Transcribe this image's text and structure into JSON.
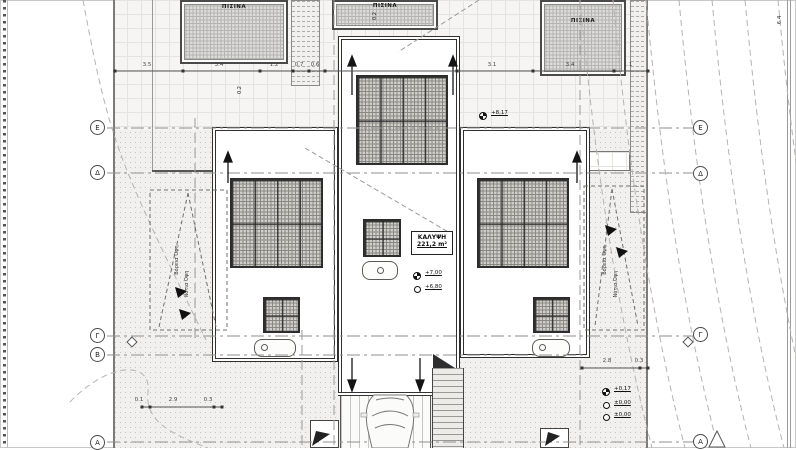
{
  "labels": {
    "pool": "ΠΙΣΙΝΑ",
    "coverage_title": "ΚΑΛΥΨΗ",
    "coverage_value": "221,2 m²",
    "slope": "Κλίση 2%",
    "view_north": "Βόρεια Όψη",
    "view_south": "Νότια Όψη"
  },
  "axes": {
    "e": "Ε",
    "d": "Δ",
    "g": "Γ",
    "b": "Β",
    "a": "Α"
  },
  "elevations": {
    "pool_deck": "+8,17",
    "roof_high": "+7,00",
    "roof_low": "+6,80",
    "entrance": "+0,17",
    "ground_a": "±0,00",
    "ground_b": "±0,00"
  },
  "dimensions": {
    "top": [
      "3.5",
      "3.4",
      "1.2",
      "0.7",
      "0.6",
      "3.1",
      "3.4",
      "1.1"
    ],
    "right_edge": "6.4",
    "pool_left_gap": "0.2",
    "pool_center_gap": "0.2",
    "bottom_left": [
      "0.1",
      "2.9",
      "0.3"
    ],
    "right_lower": [
      "2.8",
      "0.3"
    ]
  }
}
